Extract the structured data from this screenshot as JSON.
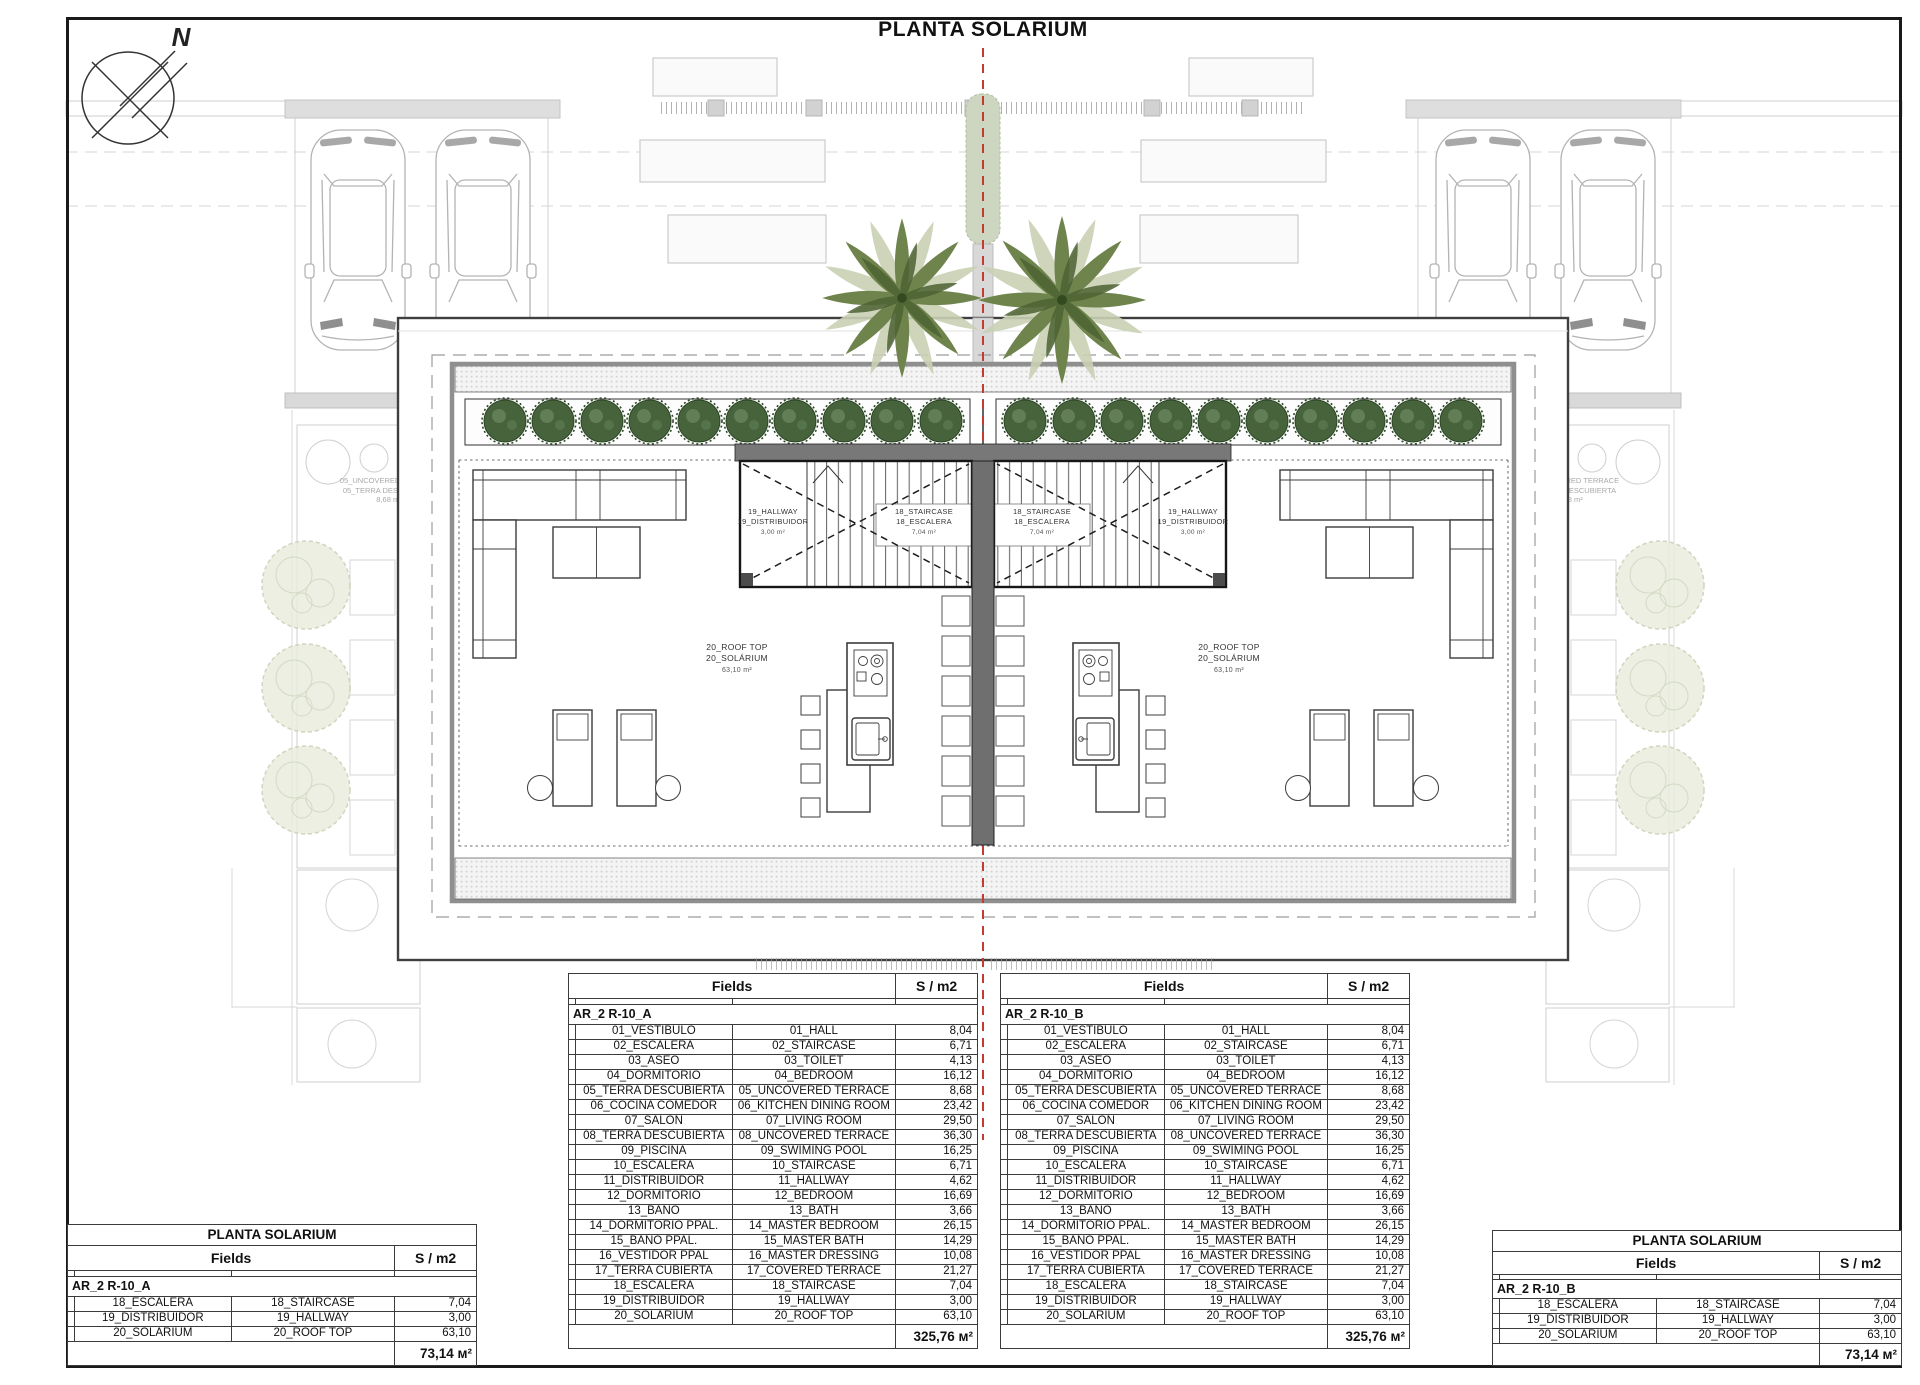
{
  "title": "PLANTA SOLARIUM",
  "compass": {
    "north_label": "N"
  },
  "plan": {
    "left_unit": {
      "rooftop": [
        "20_ROOF TOP",
        "20_SOLÁRIUM",
        "63,10 m²"
      ],
      "hallway": [
        "19_HALLWAY",
        "19_DISTRIBUIDOR",
        "3,00 m²"
      ],
      "staircase": [
        "18_STAIRCASE",
        "18_ESCALERA",
        "7,04 m²"
      ]
    },
    "right_unit": {
      "rooftop": [
        "20_ROOF TOP",
        "20_SOLÁRIUM",
        "63,10 m²"
      ],
      "hallway": [
        "19_HALLWAY",
        "19_DISTRIBUIDOR",
        "3,00 m²"
      ],
      "staircase": [
        "18_STAIRCASE",
        "18_ESCALERA",
        "7,04 m²"
      ]
    },
    "site_label": [
      "05_UNCOVERED TERRACE",
      "05_TERRA DESCUBIERTA",
      "8,68 m²"
    ]
  },
  "tables": {
    "unit_a": {
      "header_fields": "Fields",
      "header_area": "S / m2",
      "group": "AR_2 R-10_A",
      "rows": [
        [
          "01_VESTÍBULO",
          "01_HALL",
          "8,04"
        ],
        [
          "02_ESCALERA",
          "02_STAIRCASE",
          "6,71"
        ],
        [
          "03_ASEO",
          "03_TOILET",
          "4,13"
        ],
        [
          "04_DORMITORIO",
          "04_BEDROOM",
          "16,12"
        ],
        [
          "05_TERRA DESCUBIERTA",
          "05_UNCOVERED TERRACE",
          "8,68"
        ],
        [
          "06_COCINA COMEDOR",
          "06_KITCHEN DINING ROOM",
          "23,42"
        ],
        [
          "07_SALON",
          "07_LIVING ROOM",
          "29,50"
        ],
        [
          "08_TERRA DESCUBIERTA",
          "08_UNCOVERED TERRACE",
          "36,30"
        ],
        [
          "09_PISCINA",
          "09_SWIMING POOL",
          "16,25"
        ],
        [
          "10_ESCALERA",
          "10_STAIRCASE",
          "6,71"
        ],
        [
          "11_DISTRIBUIDOR",
          "11_HALLWAY",
          "4,62"
        ],
        [
          "12_DORMITORIO",
          "12_BEDROOM",
          "16,69"
        ],
        [
          "13_BAÑO",
          "13_BATH",
          "3,66"
        ],
        [
          "14_DORMITORIO PPAL.",
          "14_MASTER BEDROOM",
          "26,15"
        ],
        [
          "15_BAÑO PPAL.",
          "15_MASTER BATH",
          "14,29"
        ],
        [
          "16_VESTIDOR PPAL",
          "16_MASTER DRESSING",
          "10,08"
        ],
        [
          "17_TERRA CUBIERTA",
          "17_COVERED TERRACE",
          "21,27"
        ],
        [
          "18_ESCALERA",
          "18_STAIRCASE",
          "7,04"
        ],
        [
          "19_DISTRIBUIDOR",
          "19_HALLWAY",
          "3,00"
        ],
        [
          "20_SOLÁRIUM",
          "20_ROOF TOP",
          "63,10"
        ]
      ],
      "total": "325,76 м²"
    },
    "unit_b": {
      "header_fields": "Fields",
      "header_area": "S / m2",
      "group": "AR_2 R-10_B",
      "rows": [
        [
          "01_VESTÍBULO",
          "01_HALL",
          "8,04"
        ],
        [
          "02_ESCALERA",
          "02_STAIRCASE",
          "6,71"
        ],
        [
          "03_ASEO",
          "03_TOILET",
          "4,13"
        ],
        [
          "04_DORMITORIO",
          "04_BEDROOM",
          "16,12"
        ],
        [
          "05_TERRA DESCUBIERTA",
          "05_UNCOVERED TERRACE",
          "8,68"
        ],
        [
          "06_COCINA COMEDOR",
          "06_KITCHEN DINING ROOM",
          "23,42"
        ],
        [
          "07_SALON",
          "07_LIVING ROOM",
          "29,50"
        ],
        [
          "08_TERRA DESCUBIERTA",
          "08_UNCOVERED TERRACE",
          "36,30"
        ],
        [
          "09_PISCINA",
          "09_SWIMING POOL",
          "16,25"
        ],
        [
          "10_ESCALERA",
          "10_STAIRCASE",
          "6,71"
        ],
        [
          "11_DISTRIBUIDOR",
          "11_HALLWAY",
          "4,62"
        ],
        [
          "12_DORMITORIO",
          "12_BEDROOM",
          "16,69"
        ],
        [
          "13_BAÑO",
          "13_BATH",
          "3,66"
        ],
        [
          "14_DORMITORIO PPAL.",
          "14_MASTER BEDROOM",
          "26,15"
        ],
        [
          "15_BAÑO PPAL.",
          "15_MASTER BATH",
          "14,29"
        ],
        [
          "16_VESTIDOR PPAL",
          "16_MASTER DRESSING",
          "10,08"
        ],
        [
          "17_TERRA CUBIERTA",
          "17_COVERED TERRACE",
          "21,27"
        ],
        [
          "18_ESCALERA",
          "18_STAIRCASE",
          "7,04"
        ],
        [
          "19_DISTRIBUIDOR",
          "19_HALLWAY",
          "3,00"
        ],
        [
          "20_SOLÁRIUM",
          "20_ROOF TOP",
          "63,10"
        ]
      ],
      "total": "325,76 м²"
    },
    "solarium_a": {
      "title": "PLANTA SOLARIUM",
      "header_fields": "Fields",
      "header_area": "S / m2",
      "group": "AR_2 R-10_A",
      "rows": [
        [
          "18_ESCALERA",
          "18_STAIRCASE",
          "7,04"
        ],
        [
          "19_DISTRIBUIDOR",
          "19_HALLWAY",
          "3,00"
        ],
        [
          "20_SOLÁRIUM",
          "20_ROOF TOP",
          "63,10"
        ]
      ],
      "total": "73,14 м²"
    },
    "solarium_b": {
      "title": "PLANTA SOLARIUM",
      "header_fields": "Fields",
      "header_area": "S / m2",
      "group": "AR_2 R-10_B",
      "rows": [
        [
          "18_ESCALERA",
          "18_STAIRCASE",
          "7,04"
        ],
        [
          "19_DISTRIBUIDOR",
          "19_HALLWAY",
          "3,00"
        ],
        [
          "20_SOLÁRIUM",
          "20_ROOF TOP",
          "63,10"
        ]
      ],
      "total": "73,14 м²"
    }
  },
  "colors": {
    "wall_dark": "#6f6f6f",
    "centerline_red": "#c43c2e",
    "bush_green": "#46633c",
    "palm_green": "#6f844c",
    "faded_gray": "#cbcbcb"
  }
}
